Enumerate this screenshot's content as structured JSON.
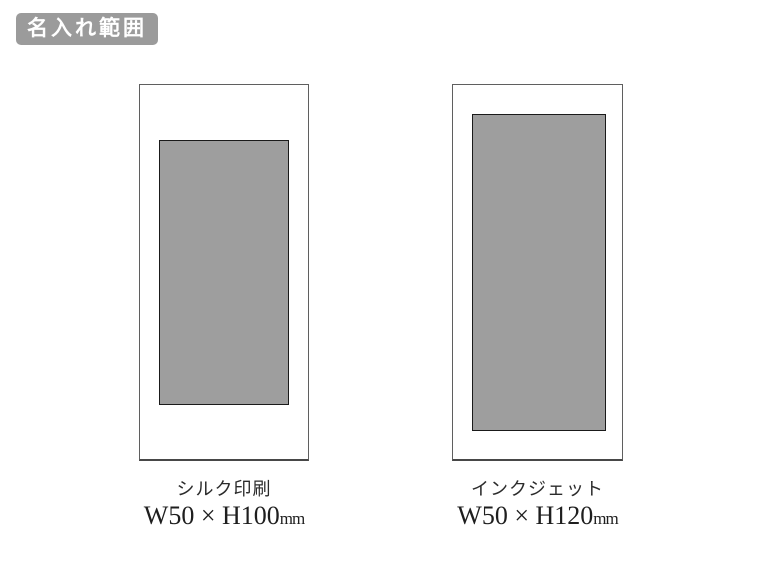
{
  "page": {
    "background_color": "#ffffff"
  },
  "badge": {
    "label": "名入れ範囲",
    "bg_color": "#9b9b9b",
    "text_color": "#ffffff"
  },
  "figures": [
    {
      "id": "silk-print",
      "method_label": "シルク印刷",
      "size_value": "W50 × H100",
      "size_unit": "mm",
      "print_area_color": "#9e9e9e",
      "print_area_border_color": "#1a1a1a",
      "outline_border_color": "#5f5f5f"
    },
    {
      "id": "inkjet",
      "method_label": "インクジェット",
      "size_value": "W50 × H120",
      "size_unit": "mm",
      "print_area_color": "#9e9e9e",
      "print_area_border_color": "#1a1a1a",
      "outline_border_color": "#5f5f5f"
    }
  ]
}
